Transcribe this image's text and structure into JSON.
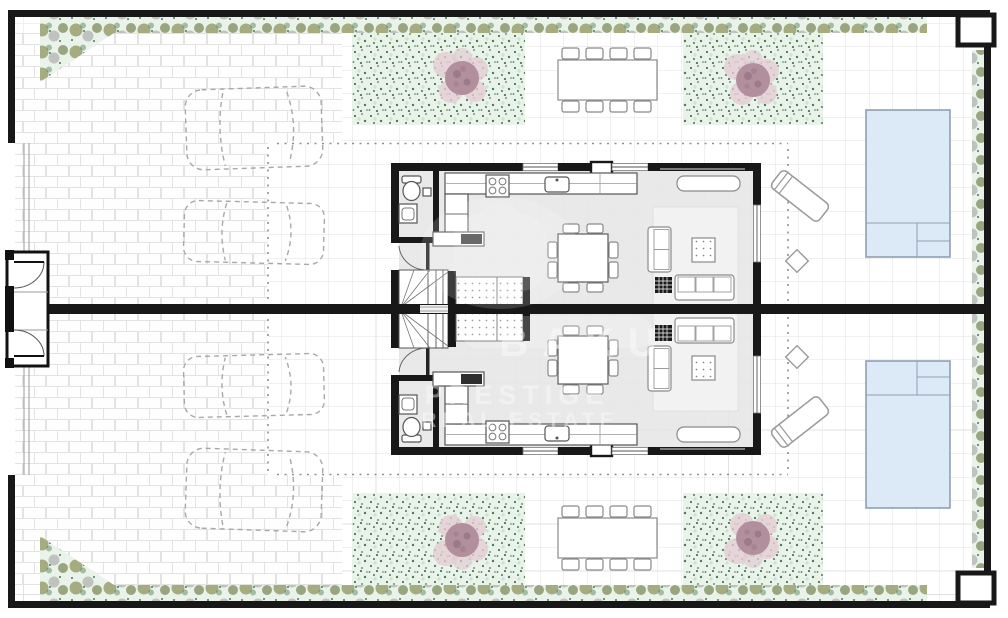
{
  "document": {
    "kind": "architectural-floor-plan",
    "description": "Site plan of two mirrored semi-detached villas with driveways, gardens, pools and terraces",
    "units": [
      {
        "id": "villa-a",
        "position": "top",
        "features": [
          "driveway-2-cars",
          "entry-gate",
          "garden-strip",
          "tree",
          "outdoor-dining-8-seats",
          "bathroom",
          "kitchen",
          "staircase",
          "indoor-dining-8-seats",
          "living-room",
          "terrace",
          "lounge-chair",
          "side-table",
          "swimming-pool"
        ]
      },
      {
        "id": "villa-b",
        "position": "bottom",
        "features": [
          "driveway-2-cars",
          "entry-gate",
          "garden-strip",
          "tree",
          "outdoor-dining-8-seats",
          "bathroom",
          "kitchen",
          "staircase",
          "indoor-dining-8-seats",
          "living-room",
          "terrace",
          "lounge-chair",
          "side-table",
          "swimming-pool"
        ]
      }
    ]
  },
  "watermark": {
    "logo": "flower-emblem",
    "lines": [
      "BAKU",
      "PRESTIGE",
      "REAL ESTATE"
    ]
  },
  "colors": {
    "wall": "#181818",
    "floor": "#e9e9e9",
    "garden-base": "#e9f3ea",
    "garden-dot": "#4c7a54",
    "shrub-olive": "#99a06d",
    "shrub-gray": "#a3a3a3",
    "tree-inner": "#b28f9c",
    "tree-halo": "#e3ccd3",
    "pool-fill": "#dce9f6",
    "pool-border": "#8fa0b0",
    "furn-line": "#8a8a8a",
    "watermark": "#ffffff"
  }
}
